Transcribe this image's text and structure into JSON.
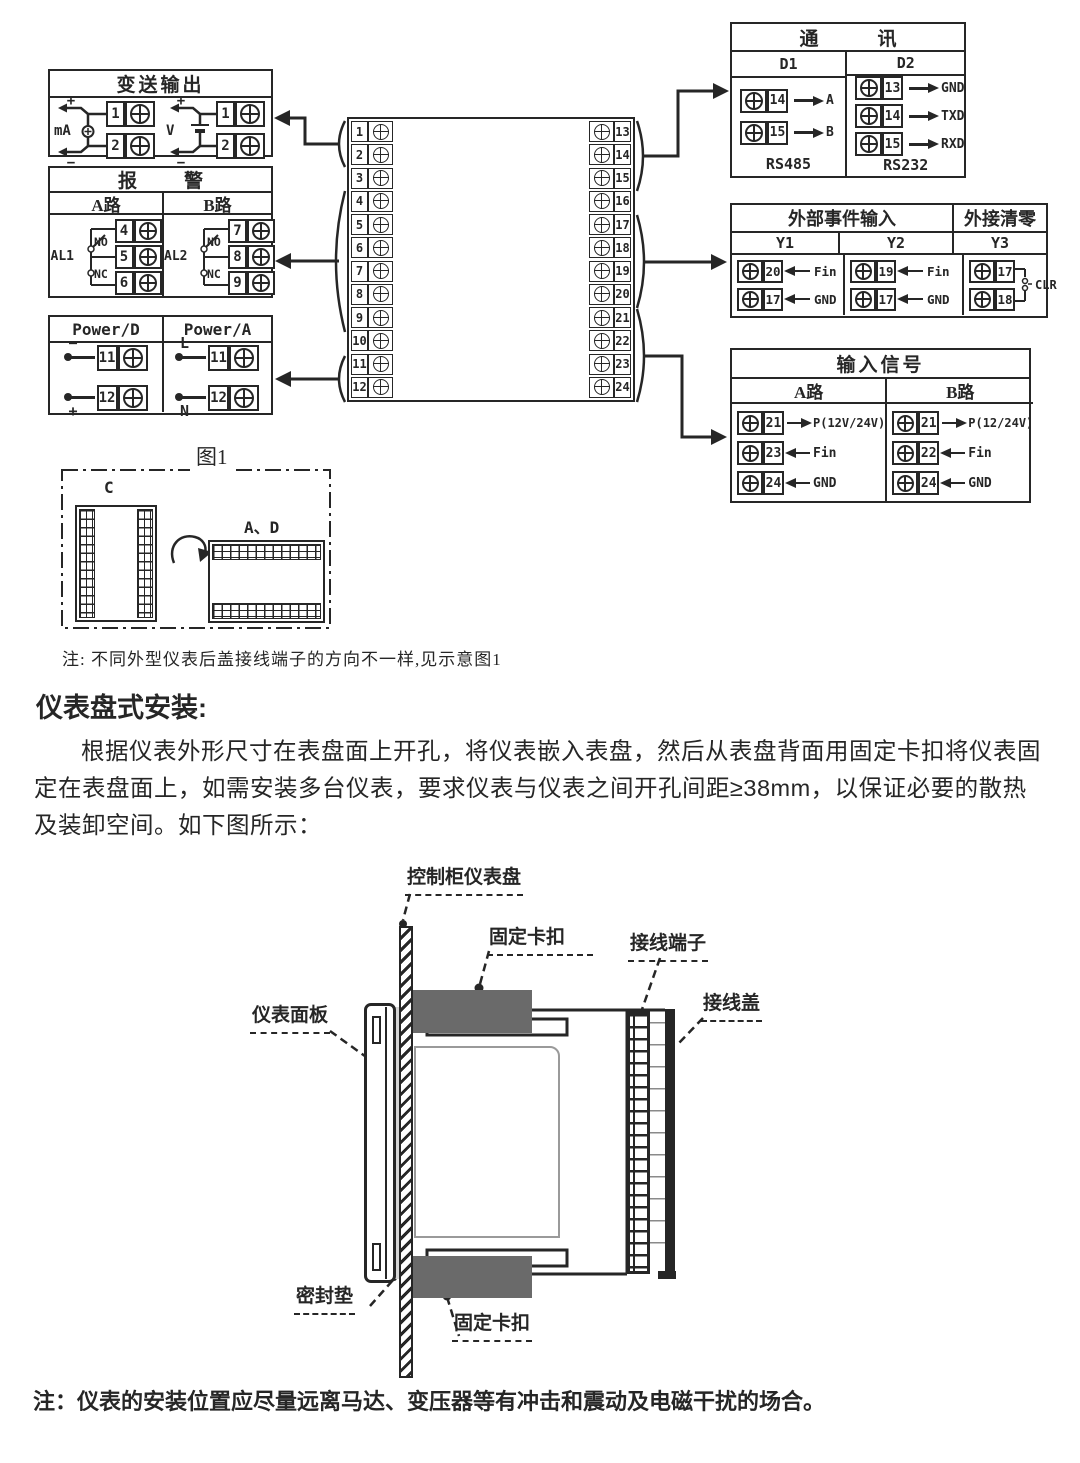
{
  "colors": {
    "ink": "#262626",
    "clip_gray": "#6a6a6a",
    "gasket_gray": "#d6d6d6",
    "window_gray": "#9a9a9a"
  },
  "boxes": {
    "transmit": {
      "title": "变送输出",
      "groups": [
        {
          "label": "mA",
          "plus": "+",
          "minus": "−",
          "pins": [
            "1",
            "2"
          ]
        },
        {
          "label": "V",
          "plus": "+",
          "minus": "−",
          "pins": [
            "1",
            "2"
          ]
        }
      ]
    },
    "alarm": {
      "title": "报　警",
      "cols": [
        {
          "header": "A路",
          "relay": "AL1",
          "no": "NO",
          "nc": "NC",
          "pins": [
            "4",
            "5",
            "6"
          ]
        },
        {
          "header": "B路",
          "relay": "AL2",
          "no": "NO",
          "nc": "NC",
          "pins": [
            "7",
            "8",
            "9"
          ]
        }
      ]
    },
    "power": {
      "cols": [
        {
          "header": "Power/D",
          "rows": [
            {
              "tag": "−",
              "pin": "11"
            },
            {
              "tag": "+",
              "pin": "12"
            }
          ]
        },
        {
          "header": "Power/A",
          "rows": [
            {
              "tag": "L",
              "pin": "11"
            },
            {
              "tag": "N",
              "pin": "12"
            }
          ]
        }
      ]
    },
    "comm": {
      "title": "通　讯",
      "cols": [
        {
          "header": "D1",
          "rows": [
            {
              "pin": "14",
              "label": "A"
            },
            {
              "pin": "15",
              "label": "B"
            }
          ],
          "footer": "RS485"
        },
        {
          "header": "D2",
          "rows": [
            {
              "pin": "13",
              "label": "GND"
            },
            {
              "pin": "14",
              "label": "TXD"
            },
            {
              "pin": "15",
              "label": "RXD"
            }
          ],
          "footer": "RS232"
        }
      ]
    },
    "event": {
      "titles": [
        "外部事件输入",
        "外接清零"
      ],
      "headers": [
        "Y1",
        "Y2",
        "Y3"
      ],
      "cols": [
        {
          "rows": [
            {
              "pin": "20",
              "label": "Fin"
            },
            {
              "pin": "17",
              "label": "GND"
            }
          ]
        },
        {
          "rows": [
            {
              "pin": "19",
              "label": "Fin"
            },
            {
              "pin": "17",
              "label": "GND"
            }
          ]
        }
      ],
      "clear": {
        "pins": [
          "17",
          "18"
        ],
        "label": "CLR"
      }
    },
    "input": {
      "title": "输入信号",
      "cols": [
        {
          "header": "A路",
          "rows": [
            {
              "pin": "21",
              "label": "P(12V/24V)"
            },
            {
              "pin": "23",
              "label": "Fin"
            },
            {
              "pin": "24",
              "label": "GND"
            }
          ]
        },
        {
          "header": "B路",
          "rows": [
            {
              "pin": "21",
              "label": "P(12/24V)"
            },
            {
              "pin": "22",
              "label": "Fin"
            },
            {
              "pin": "24",
              "label": "GND"
            }
          ]
        }
      ]
    }
  },
  "center_block": {
    "left_pins": [
      "1",
      "2",
      "3",
      "4",
      "5",
      "6",
      "7",
      "8",
      "9",
      "10",
      "11",
      "12"
    ],
    "right_pins": [
      "13",
      "14",
      "15",
      "16",
      "17",
      "18",
      "19",
      "20",
      "21",
      "22",
      "23",
      "24"
    ]
  },
  "figure1": {
    "caption": "图1",
    "label_c": "C",
    "label_ad": "A、D"
  },
  "notes": {
    "note1": "注: 不同外型仪表后盖接线端子的方向不一样,见示意图1",
    "note2": "注：仪表的安装位置应尽量远离马达、变压器等有冲击和震动及电磁干扰的场合。"
  },
  "section": {
    "heading": "仪表盘式安装:",
    "paragraph": "根据仪表外形尺寸在表盘面上开孔，将仪表嵌入表盘，然后从表盘背面用固定卡扣将仪表固定在表盘面上，如需安装多台仪表，要求仪表与仪表之间开孔间距≥38mm，以保证必要的散热及装卸空间。如下图所示："
  },
  "mount_labels": {
    "panel": "控制柜仪表盘",
    "clip_top": "固定卡扣",
    "terminal": "接线端子",
    "cover": "接线盖",
    "front_panel": "仪表面板",
    "gasket": "密封垫",
    "clip_bottom": "固定卡扣"
  }
}
